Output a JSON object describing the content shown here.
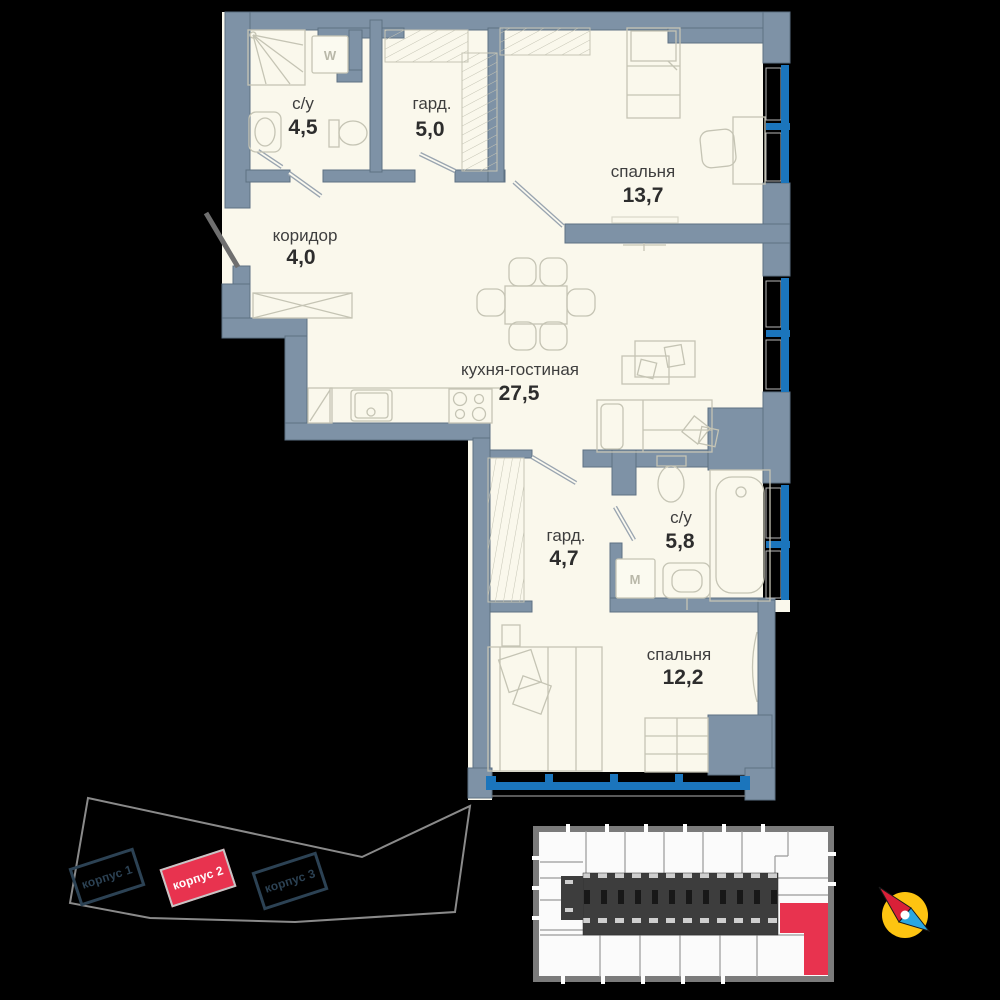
{
  "floorplan": {
    "rooms": [
      {
        "name": "с/у",
        "area": "4,5"
      },
      {
        "name": "гард.",
        "area": "5,0"
      },
      {
        "name": "спальня",
        "area": "13,7"
      },
      {
        "name": "коридор",
        "area": "4,0"
      },
      {
        "name": "кухня-гостиная",
        "area": "27,5"
      },
      {
        "name": "гард.",
        "area": "4,7"
      },
      {
        "name": "с/у",
        "area": "5,8"
      },
      {
        "name": "спальня",
        "area": "12,2"
      }
    ],
    "appliances": {
      "washer_top": "W",
      "washer_bottom": "M"
    }
  },
  "site_plan": {
    "buildings": [
      {
        "label": "корпус 1"
      },
      {
        "label": "корпус 2"
      },
      {
        "label": "корпус 3"
      }
    ],
    "highlighted_building": "корпус 2"
  },
  "colors": {
    "floor": "#faf8ec",
    "wall": "#7e92a6",
    "window_blue": "#1b75bc",
    "accent_red": "#e8334f",
    "compass_yellow": "#fdc411",
    "compass_red": "#d92038",
    "compass_blue": "#2aa7e0"
  }
}
